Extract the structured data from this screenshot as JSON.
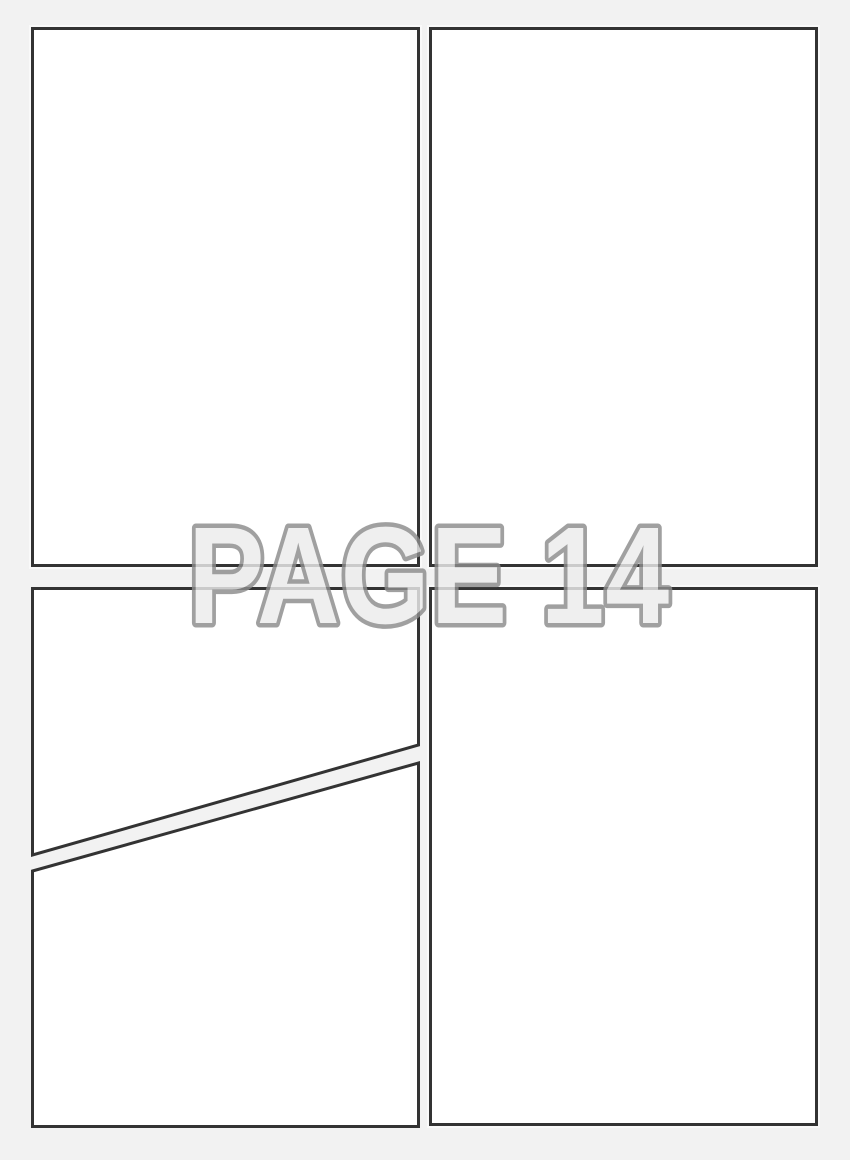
{
  "page": {
    "watermark_text": "PAGE 14"
  },
  "colors": {
    "page_background": "#f2f2f2",
    "panel_fill": "#ffffff",
    "panel_border": "#333333",
    "watermark_fill": "#ececec",
    "watermark_outline": "#8c8c8c"
  }
}
